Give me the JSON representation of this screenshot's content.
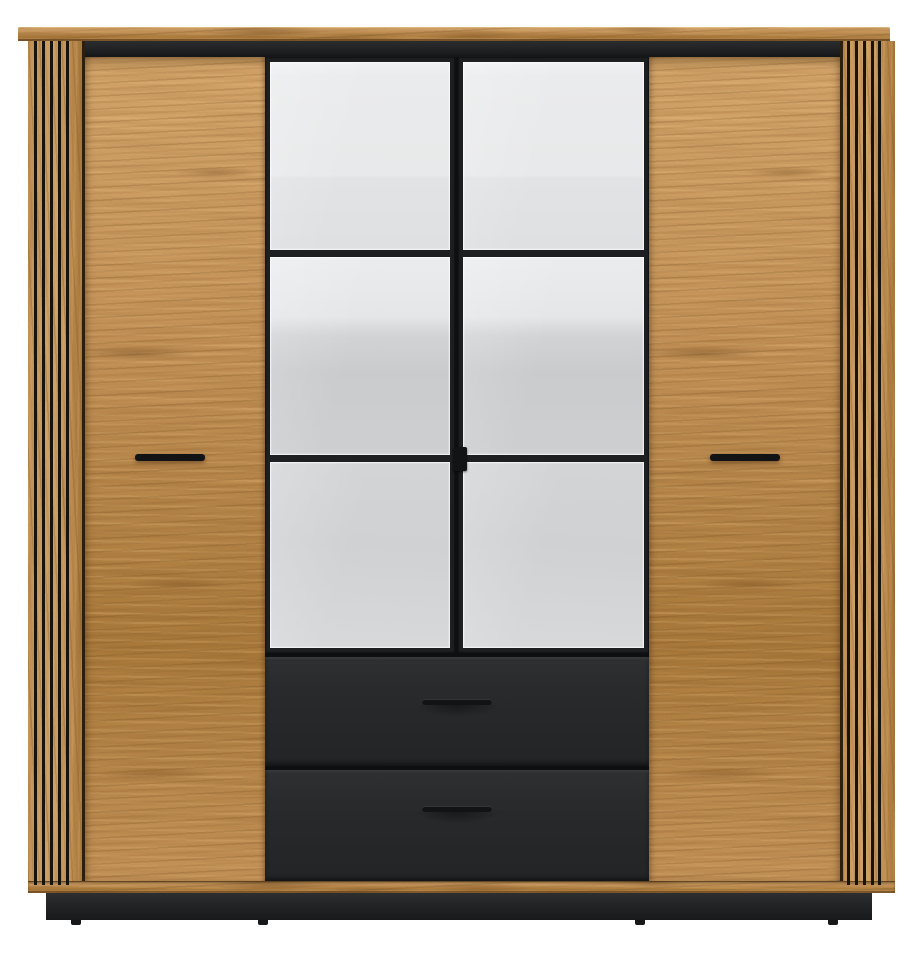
{
  "meta": {
    "type": "product-photo",
    "subject": "Four-door wardrobe with fluted oak side panels, two oak doors, two mirrored doors (three panes each) and two black drawers",
    "background_color": "#ffffff"
  },
  "wardrobe": {
    "structure": {
      "doors_total": 4,
      "wood_doors": 2,
      "mirror_doors": 2,
      "mirror_panes_per_door": 3,
      "drawers": 2,
      "slat_grooves_per_side_panel": 5,
      "feet_visible": 4
    },
    "parts": {
      "top_board": "oak top board",
      "top_trim": "black trim strip under top board",
      "left_slat_panel": "fluted oak side panel",
      "right_slat_panel": "fluted oak side panel",
      "left_door": "oak hinged door",
      "right_door": "oak hinged door",
      "mirror_left_door": "mirrored door with black frame, 3 panes",
      "mirror_right_door": "mirrored door with black frame, 3 panes",
      "drawer_top": "black drawer front",
      "drawer_bottom": "black drawer front",
      "base_strip": "oak base strip",
      "plinth": "black recessed plinth"
    },
    "handles": {
      "wood_door_handle": "black horizontal bar handle",
      "mirror_door_handle": "small black tab at centre seam",
      "drawer_handle": "recessed black bar handle"
    }
  },
  "colors": {
    "background": "#ffffff",
    "wood-base": "#cb9a5e",
    "wood-light": "#dcae72",
    "wood-dark": "#b0803f",
    "wood-streak": "#7c5423",
    "seam": "#2c1f0d",
    "black-frame": "#1d1f21",
    "black-strip": "#202224",
    "drawer-front": "#282a2c",
    "drawer-front-dark": "#222426",
    "plinth": "#232527",
    "handle": "#111314",
    "mirror-1-top": "#f0f1f2",
    "mirror-1-bottom": "#dee0e1",
    "mirror-2-top": "#ebeced",
    "mirror-2-bottom": "#cdcfd1",
    "mirror-3": "#d2d4d6"
  }
}
